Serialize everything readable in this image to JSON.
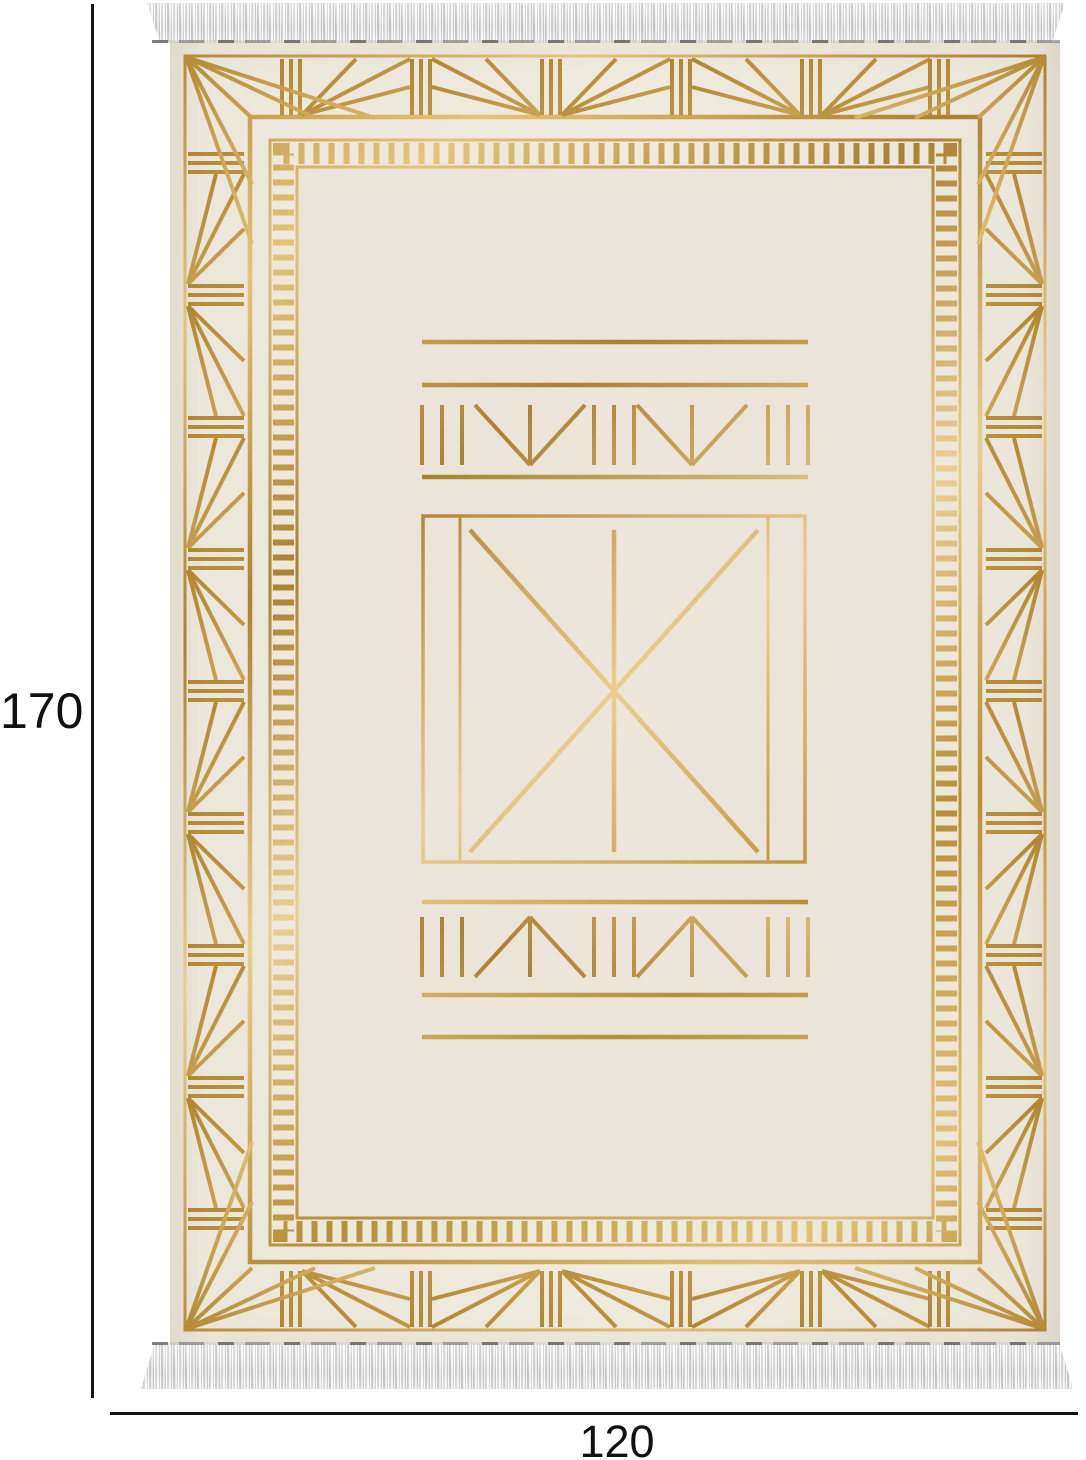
{
  "figure": {
    "name": "gold-art-deco-rug-dimension-diagram",
    "height_label": "170",
    "width_label": "120"
  },
  "colors": {
    "rug_base": "#ece7db",
    "gold": "#c79f4a",
    "gold_light": "#e9cf90",
    "gold_dark": "#a9812e",
    "fringe": "#efefef",
    "dimension_line": "#141414",
    "label_text": "#111111"
  }
}
